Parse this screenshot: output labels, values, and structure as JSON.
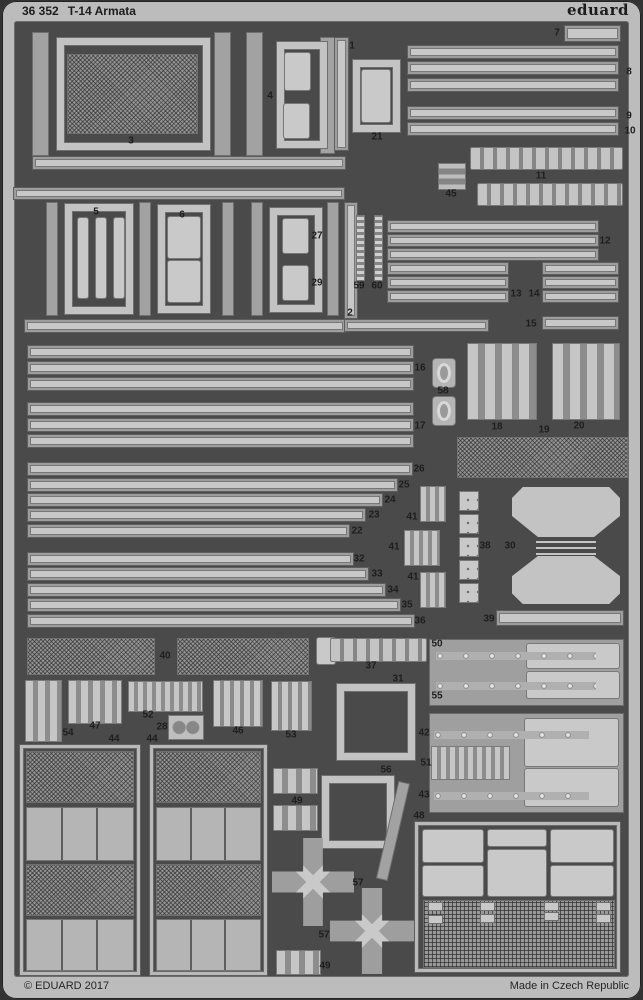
{
  "header": {
    "catalog": "36 352",
    "title": "T-14 Armata",
    "brand": "eduard"
  },
  "footer": {
    "copyright": "© EDUARD 2017",
    "made_in": "Made in Czech Republic"
  },
  "colors": {
    "background": "#333333",
    "fret_light": "#bcbcbc",
    "interior_dark": "#4a4a4a",
    "rail_medium": "#a2a2a2",
    "part_light": "#c8c8c8",
    "label_text": "#1e1e1e"
  },
  "sheet": {
    "labels": [
      [
        "1",
        352,
        46
      ],
      [
        "2",
        350,
        313
      ],
      [
        "3",
        131,
        141
      ],
      [
        "4",
        270,
        96
      ],
      [
        "5",
        96,
        212
      ],
      [
        "6",
        182,
        215
      ],
      [
        "7",
        557,
        33
      ],
      [
        "8",
        629,
        72
      ],
      [
        "9",
        629,
        116
      ],
      [
        "10",
        630,
        131
      ],
      [
        "11",
        541,
        176
      ],
      [
        "12",
        605,
        241
      ],
      [
        "13",
        516,
        294
      ],
      [
        "14",
        534,
        294
      ],
      [
        "15",
        531,
        324
      ],
      [
        "16",
        420,
        368
      ],
      [
        "17",
        420,
        426
      ],
      [
        "18",
        497,
        427
      ],
      [
        "19",
        544,
        430
      ],
      [
        "20",
        579,
        426
      ],
      [
        "21",
        377,
        137
      ],
      [
        "22",
        357,
        531
      ],
      [
        "23",
        374,
        515
      ],
      [
        "24",
        390,
        500
      ],
      [
        "25",
        404,
        485
      ],
      [
        "26",
        419,
        469
      ],
      [
        "27",
        317,
        236
      ],
      [
        "28",
        162,
        727
      ],
      [
        "29",
        317,
        283
      ],
      [
        "30",
        510,
        546
      ],
      [
        "31",
        398,
        679
      ],
      [
        "32",
        359,
        559
      ],
      [
        "33",
        377,
        574
      ],
      [
        "34",
        393,
        590
      ],
      [
        "35",
        407,
        605
      ],
      [
        "36",
        420,
        621
      ],
      [
        "37",
        371,
        666
      ],
      [
        "38",
        485,
        546
      ],
      [
        "39",
        489,
        619
      ],
      [
        "40",
        165,
        656
      ],
      [
        "41",
        412,
        517
      ],
      [
        "41",
        394,
        547
      ],
      [
        "41",
        413,
        577
      ],
      [
        "42",
        424,
        733
      ],
      [
        "43",
        424,
        795
      ],
      [
        "44",
        114,
        739
      ],
      [
        "44",
        152,
        739
      ],
      [
        "45",
        451,
        194
      ],
      [
        "46",
        238,
        731
      ],
      [
        "47",
        95,
        726
      ],
      [
        "48",
        419,
        816
      ],
      [
        "49",
        297,
        801
      ],
      [
        "49",
        325,
        966
      ],
      [
        "50",
        437,
        644
      ],
      [
        "51",
        426,
        763
      ],
      [
        "52",
        148,
        715
      ],
      [
        "53",
        291,
        735
      ],
      [
        "54",
        68,
        733
      ],
      [
        "55",
        437,
        696
      ],
      [
        "56",
        386,
        770
      ],
      [
        "57",
        358,
        883
      ],
      [
        "57",
        324,
        935
      ],
      [
        "58",
        443,
        391
      ],
      [
        "59",
        359,
        286
      ],
      [
        "60",
        377,
        286
      ]
    ],
    "shapes": [
      [
        "rail",
        33,
        33,
        15,
        122
      ],
      [
        "rail",
        215,
        33,
        15,
        122
      ],
      [
        "rail",
        247,
        33,
        15,
        122
      ],
      [
        "rail",
        321,
        38,
        13,
        115
      ],
      [
        "strip",
        335,
        38,
        13,
        112
      ],
      [
        "frame",
        57,
        38,
        153,
        112
      ],
      [
        "mesh",
        67,
        54,
        131,
        80
      ],
      [
        "frame",
        277,
        42,
        50,
        106
      ],
      [
        "plate",
        285,
        53,
        25,
        37
      ],
      [
        "plate",
        284,
        104,
        25,
        34
      ],
      [
        "frame",
        353,
        60,
        47,
        72
      ],
      [
        "plate",
        362,
        70,
        28,
        52
      ],
      [
        "strip",
        408,
        46,
        210,
        12
      ],
      [
        "strip",
        408,
        62,
        210,
        12
      ],
      [
        "strip",
        408,
        79,
        210,
        12
      ],
      [
        "strip",
        408,
        107,
        210,
        12
      ],
      [
        "strip",
        408,
        123,
        210,
        12
      ],
      [
        "strip",
        565,
        26,
        55,
        15
      ],
      [
        "emblem",
        438,
        163,
        28,
        27
      ],
      [
        "bottles",
        470,
        147,
        153,
        23
      ],
      [
        "bottles",
        477,
        183,
        146,
        23
      ],
      [
        "strip",
        33,
        157,
        312,
        12
      ],
      [
        "strip",
        14,
        188,
        330,
        11
      ],
      [
        "rail",
        47,
        203,
        10,
        112
      ],
      [
        "rail",
        140,
        203,
        10,
        112
      ],
      [
        "rail",
        223,
        203,
        10,
        112
      ],
      [
        "rail",
        252,
        203,
        10,
        112
      ],
      [
        "rail",
        328,
        203,
        10,
        112
      ],
      [
        "strip",
        345,
        203,
        12,
        115
      ],
      [
        "frame",
        65,
        204,
        68,
        110
      ],
      [
        "plate",
        78,
        218,
        10,
        80
      ],
      [
        "plate",
        96,
        218,
        10,
        80
      ],
      [
        "plate",
        114,
        218,
        10,
        80
      ],
      [
        "frame",
        158,
        205,
        52,
        108
      ],
      [
        "plate",
        168,
        217,
        32,
        41
      ],
      [
        "plate",
        168,
        261,
        32,
        41
      ],
      [
        "frame",
        270,
        208,
        52,
        104
      ],
      [
        "plate",
        283,
        219,
        25,
        34
      ],
      [
        "plate",
        283,
        266,
        25,
        34
      ],
      [
        "chain",
        356,
        215,
        9,
        66
      ],
      [
        "chain",
        374,
        215,
        9,
        66
      ],
      [
        "strip",
        388,
        221,
        210,
        11
      ],
      [
        "strip",
        388,
        235,
        210,
        11
      ],
      [
        "strip",
        388,
        249,
        210,
        11
      ],
      [
        "strip",
        388,
        263,
        120,
        11
      ],
      [
        "strip",
        388,
        277,
        120,
        11
      ],
      [
        "strip",
        388,
        291,
        120,
        11
      ],
      [
        "strip",
        543,
        263,
        75,
        11
      ],
      [
        "strip",
        543,
        277,
        75,
        11
      ],
      [
        "strip",
        543,
        291,
        75,
        11
      ],
      [
        "strip",
        543,
        317,
        75,
        12
      ],
      [
        "strip",
        25,
        320,
        320,
        12
      ],
      [
        "strip",
        345,
        320,
        143,
        11
      ],
      [
        "strip",
        28,
        346,
        385,
        12
      ],
      [
        "strip",
        28,
        362,
        385,
        12
      ],
      [
        "strip",
        28,
        378,
        385,
        12
      ],
      [
        "strip",
        28,
        403,
        385,
        12
      ],
      [
        "strip",
        28,
        419,
        385,
        12
      ],
      [
        "strip",
        28,
        435,
        385,
        12
      ],
      [
        "grommet",
        433,
        359,
        22,
        28
      ],
      [
        "grommet",
        433,
        397,
        22,
        28
      ],
      [
        "combs",
        467,
        343,
        70,
        77
      ],
      [
        "combs",
        552,
        343,
        68,
        77
      ],
      [
        "mesh",
        457,
        437,
        171,
        41
      ],
      [
        "strip",
        28,
        463,
        384,
        12
      ],
      [
        "strip",
        28,
        479,
        369,
        12
      ],
      [
        "strip",
        28,
        494,
        354,
        12
      ],
      [
        "strip",
        28,
        509,
        337,
        12
      ],
      [
        "strip",
        28,
        525,
        321,
        12
      ],
      [
        "strip",
        28,
        553,
        325,
        12
      ],
      [
        "strip",
        28,
        568,
        340,
        12
      ],
      [
        "strip",
        28,
        584,
        357,
        12
      ],
      [
        "strip",
        28,
        599,
        372,
        12
      ],
      [
        "strip",
        28,
        615,
        386,
        12
      ],
      [
        "pins",
        420,
        486,
        26,
        36
      ],
      [
        "pins",
        404,
        530,
        36,
        36
      ],
      [
        "pins",
        420,
        572,
        26,
        36
      ],
      [
        "padsq",
        460,
        492,
        18,
        18
      ],
      [
        "padsq",
        460,
        515,
        18,
        18
      ],
      [
        "padsq",
        460,
        538,
        18,
        18
      ],
      [
        "padsq",
        460,
        561,
        18,
        18
      ],
      [
        "padsq",
        460,
        584,
        18,
        18
      ],
      [
        "trapup",
        512,
        487,
        108,
        50
      ],
      [
        "ladder",
        536,
        539,
        60,
        16
      ],
      [
        "trapdn",
        512,
        556,
        108,
        48
      ],
      [
        "strip",
        497,
        611,
        126,
        14
      ],
      [
        "mesh",
        27,
        638,
        128,
        37
      ],
      [
        "mesh",
        177,
        638,
        132,
        37
      ],
      [
        "plate",
        317,
        638,
        18,
        26
      ],
      [
        "slats",
        25,
        680,
        37,
        62
      ],
      [
        "slats",
        68,
        680,
        54,
        44
      ],
      [
        "pins",
        128,
        681,
        75,
        31
      ],
      [
        "gears",
        169,
        716,
        34,
        23
      ],
      [
        "ovals",
        213,
        680,
        50,
        47
      ],
      [
        "ovals",
        271,
        681,
        41,
        50
      ],
      [
        "bottles",
        330,
        638,
        97,
        24
      ],
      [
        "frame",
        337,
        684,
        78,
        76
      ],
      [
        "block",
        430,
        640,
        193,
        65
      ],
      [
        "plate",
        527,
        644,
        92,
        24
      ],
      [
        "plate",
        527,
        672,
        92,
        26
      ],
      [
        "dotstrip",
        436,
        652,
        160,
        8
      ],
      [
        "dotstrip",
        436,
        682,
        160,
        8
      ],
      [
        "block",
        430,
        714,
        193,
        98
      ],
      [
        "plate",
        525,
        719,
        93,
        47
      ],
      [
        "plate",
        525,
        769,
        93,
        37
      ],
      [
        "dotstrip",
        434,
        731,
        155,
        8
      ],
      [
        "dotstrip",
        434,
        792,
        155,
        8
      ],
      [
        "pins",
        431,
        746,
        79,
        34
      ],
      [
        "tframe",
        20,
        745,
        120,
        230
      ],
      [
        "mesh",
        26,
        751,
        108,
        52
      ],
      [
        "panes3",
        26,
        807,
        108,
        54
      ],
      [
        "mesh",
        26,
        864,
        108,
        52
      ],
      [
        "panes3",
        26,
        919,
        108,
        52
      ],
      [
        "tframe",
        150,
        745,
        117,
        230
      ],
      [
        "mesh",
        156,
        751,
        105,
        52
      ],
      [
        "panes3",
        156,
        807,
        105,
        54
      ],
      [
        "mesh",
        156,
        864,
        105,
        52
      ],
      [
        "panes3",
        156,
        919,
        105,
        52
      ],
      [
        "cluster",
        273,
        768,
        45,
        26
      ],
      [
        "cluster",
        273,
        805,
        45,
        26
      ],
      [
        "cluster",
        276,
        950,
        45,
        25
      ],
      [
        "frame",
        322,
        776,
        72,
        72
      ],
      [
        "rail",
        388,
        782,
        10,
        98,
        13
      ],
      [
        "spider",
        272,
        838,
        82,
        88
      ],
      [
        "spider",
        330,
        888,
        84,
        86
      ],
      [
        "tframe",
        415,
        822,
        205,
        150
      ],
      [
        "plate",
        423,
        830,
        60,
        32
      ],
      [
        "plate",
        423,
        866,
        60,
        30
      ],
      [
        "plate",
        488,
        830,
        58,
        16
      ],
      [
        "plate",
        488,
        850,
        58,
        46
      ],
      [
        "plate",
        551,
        830,
        62,
        32
      ],
      [
        "plate",
        551,
        866,
        62,
        30
      ],
      [
        "gridmesh",
        423,
        900,
        192,
        68
      ],
      [
        "tab",
        429,
        903,
        13,
        7
      ],
      [
        "tab",
        429,
        916,
        13,
        7
      ],
      [
        "tab",
        481,
        903,
        13,
        7
      ],
      [
        "tab",
        481,
        915,
        13,
        7
      ],
      [
        "tab",
        545,
        903,
        13,
        7
      ],
      [
        "tab",
        545,
        913,
        13,
        7
      ],
      [
        "tab",
        597,
        903,
        13,
        7
      ],
      [
        "tab",
        597,
        915,
        13,
        7
      ]
    ]
  }
}
